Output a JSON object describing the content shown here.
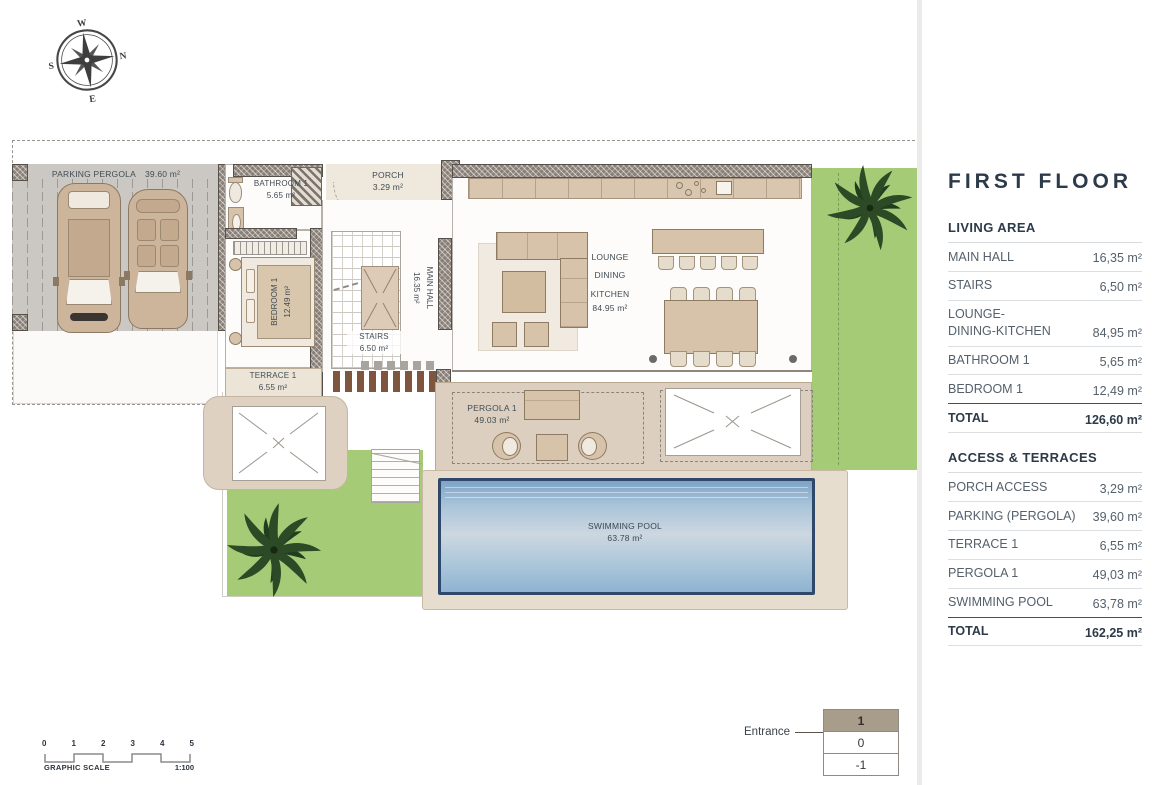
{
  "panel": {
    "title": "FIRST FLOOR",
    "living": {
      "header": "LIVING AREA",
      "rows": [
        {
          "label": "MAIN HALL",
          "value": "16,35 m²"
        },
        {
          "label": "STAIRS",
          "value": "6,50 m²"
        },
        {
          "label": "LOUNGE-\nDINING-KITCHEN",
          "value": "84,95 m²"
        },
        {
          "label": "BATHROOM 1",
          "value": "5,65 m²"
        },
        {
          "label": "BEDROOM 1",
          "value": "12,49 m²"
        }
      ],
      "total_label": "TOTAL",
      "total_value": "126,60 m²"
    },
    "access": {
      "header": "ACCESS & TERRACES",
      "rows": [
        {
          "label": "PORCH ACCESS",
          "value": "3,29 m²"
        },
        {
          "label": "PARKING (PERGOLA)",
          "value": "39,60 m²"
        },
        {
          "label": "TERRACE 1",
          "value": "6,55 m²"
        },
        {
          "label": "PERGOLA 1",
          "value": "49,03 m²"
        },
        {
          "label": "SWIMMING POOL",
          "value": "63,78 m²"
        }
      ],
      "total_label": "TOTAL",
      "total_value": "162,25 m²"
    }
  },
  "plan": {
    "parking": {
      "name": "PARKING PERGOLA",
      "area": "39.60 m²"
    },
    "bathroom": {
      "name": "BATHROOM 1",
      "area": "5.65 m²"
    },
    "porch": {
      "name": "PORCH",
      "area": "3.29 m²"
    },
    "bedroom": {
      "name": "BEDROOM 1",
      "area": "12.49 m²"
    },
    "terrace": {
      "name": "TERRACE 1",
      "area": "6.55 m²"
    },
    "stairs": {
      "name": "STAIRS",
      "area": "6.50 m²"
    },
    "main_hall": {
      "name": "MAIN HALL",
      "area": "16.35 m²"
    },
    "lounge": {
      "l1": "LOUNGE",
      "l2": "DINING",
      "l3": "KITCHEN",
      "area": "84.95 m²"
    },
    "pergola": {
      "name": "PERGOLA 1",
      "area": "49.03 m²"
    },
    "pool": {
      "name": "SWIMMING POOL",
      "area": "63.78 m²"
    }
  },
  "entrance": {
    "label": "Entrance",
    "levels": [
      "1",
      "0",
      "-1"
    ]
  },
  "scale": {
    "ticks": [
      "0",
      "1",
      "2",
      "3",
      "4",
      "5"
    ],
    "label": "GRAPHIC SCALE",
    "ratio": "1:100"
  },
  "compass": {
    "n": "N",
    "s": "S",
    "e": "E",
    "w": "W"
  },
  "colors": {
    "grass": "#a5cb77",
    "pool_deep": "#7ea3c6",
    "taupe_strip": "#dccfc0",
    "active_floor": "#a89c8b"
  }
}
